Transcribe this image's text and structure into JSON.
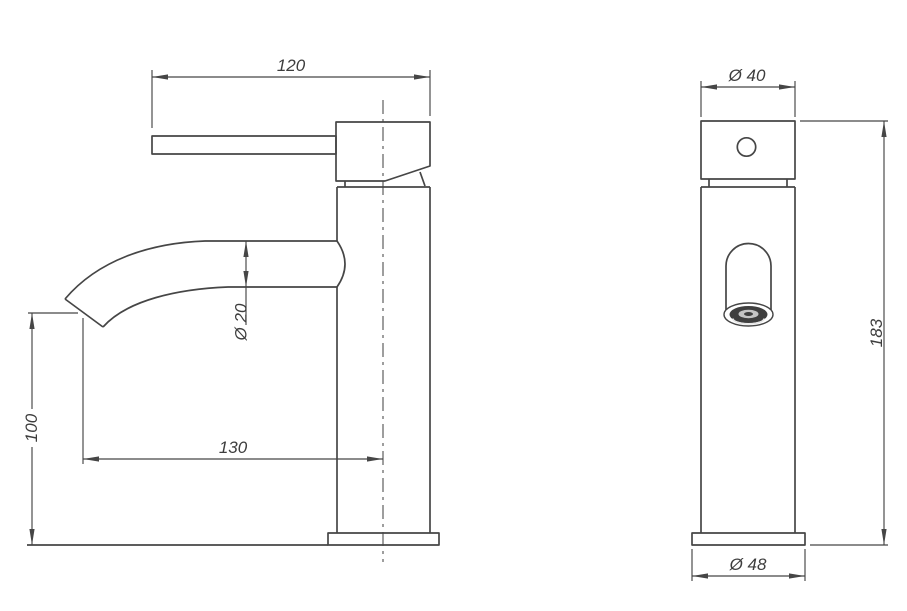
{
  "canvas": {
    "line_color": "#464646",
    "text_color": "#3d3d3d",
    "background": "#ffffff"
  },
  "drawing": {
    "type": "faucet-dimensional-drawing",
    "side_view": {
      "dims": {
        "handle_length": "120",
        "spout_diameter": "Ø 20",
        "outlet_height": "100",
        "spout_reach": "130"
      }
    },
    "front_view": {
      "dims": {
        "body_diameter": "Ø 40",
        "total_height": "183",
        "base_diameter": "Ø 48"
      }
    }
  }
}
